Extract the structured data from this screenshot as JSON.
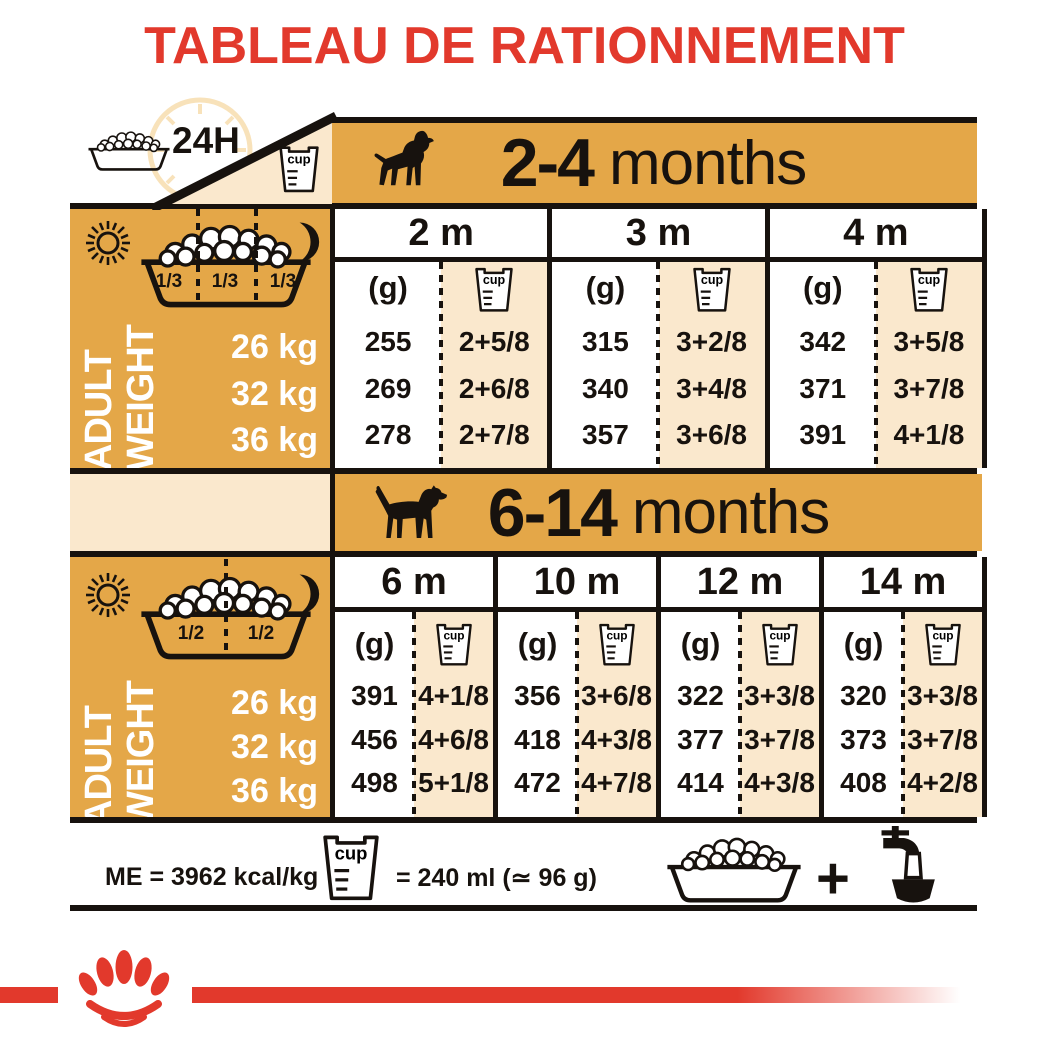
{
  "title": "TABLEAU DE RATIONNEMENT",
  "legend": {
    "hours": "24H",
    "cup": "cup"
  },
  "colors": {
    "orange": "#E4A748",
    "beige": "#FAE8CD",
    "red": "#E2392C",
    "ink": "#17120E"
  },
  "sections": [
    {
      "age_bold": "2-4",
      "age_rest": "months",
      "dog_icon": "puppy-silhouette",
      "bowl_fractions": [
        "1/3",
        "1/3",
        "1/3"
      ],
      "axis": {
        "line1": "ADULT",
        "line2": "WEIGHT"
      },
      "weights": [
        "26 kg",
        "32 kg",
        "36 kg"
      ],
      "g_label": "(g)",
      "columns": [
        {
          "month": "2 m",
          "grams": [
            "255",
            "269",
            "278"
          ],
          "cups": [
            "2+5/8",
            "2+6/8",
            "2+7/8"
          ]
        },
        {
          "month": "3 m",
          "grams": [
            "315",
            "340",
            "357"
          ],
          "cups": [
            "3+2/8",
            "3+4/8",
            "3+6/8"
          ]
        },
        {
          "month": "4 m",
          "grams": [
            "342",
            "371",
            "391"
          ],
          "cups": [
            "3+5/8",
            "3+7/8",
            "4+1/8"
          ]
        }
      ]
    },
    {
      "age_bold": "6-14",
      "age_rest": "months",
      "dog_icon": "adult-dog-silhouette",
      "bowl_fractions": [
        "1/2",
        "1/2"
      ],
      "axis": {
        "line1": "ADULT",
        "line2": "WEIGHT"
      },
      "weights": [
        "26 kg",
        "32 kg",
        "36 kg"
      ],
      "g_label": "(g)",
      "columns": [
        {
          "month": "6 m",
          "grams": [
            "391",
            "456",
            "498"
          ],
          "cups": [
            "4+1/8",
            "4+6/8",
            "5+1/8"
          ]
        },
        {
          "month": "10 m",
          "grams": [
            "356",
            "418",
            "472"
          ],
          "cups": [
            "3+6/8",
            "4+3/8",
            "4+7/8"
          ]
        },
        {
          "month": "12 m",
          "grams": [
            "322",
            "377",
            "414"
          ],
          "cups": [
            "3+3/8",
            "3+7/8",
            "4+3/8"
          ]
        },
        {
          "month": "14 m",
          "grams": [
            "320",
            "373",
            "408"
          ],
          "cups": [
            "3+3/8",
            "3+7/8",
            "4+2/8"
          ]
        }
      ]
    }
  ],
  "footer": {
    "me": "ME = 3962 kcal/kg",
    "equals": "= 240 ml (≃ 96 g)"
  },
  "chart_data": {
    "type": "table",
    "title": "TABLEAU DE RATIONNEMENT",
    "row_header": "ADULT WEIGHT",
    "rows": [
      "26 kg",
      "32 kg",
      "36 kg"
    ],
    "groups": [
      {
        "age": "2-4 months",
        "columns": [
          "2 m",
          "3 m",
          "4 m"
        ],
        "grams": [
          [
            255,
            315,
            342
          ],
          [
            269,
            340,
            371
          ],
          [
            278,
            357,
            391
          ]
        ],
        "cups": [
          [
            "2+5/8",
            "3+2/8",
            "3+5/8"
          ],
          [
            "2+6/8",
            "3+4/8",
            "3+7/8"
          ],
          [
            "2+7/8",
            "3+6/8",
            "4+1/8"
          ]
        ],
        "meals_per_day": "1/3 + 1/3 + 1/3"
      },
      {
        "age": "6-14 months",
        "columns": [
          "6 m",
          "10 m",
          "12 m",
          "14 m"
        ],
        "grams": [
          [
            391,
            356,
            322,
            320
          ],
          [
            456,
            418,
            377,
            373
          ],
          [
            498,
            472,
            414,
            408
          ]
        ],
        "cups": [
          [
            "4+1/8",
            "3+6/8",
            "3+3/8",
            "3+3/8"
          ],
          [
            "4+6/8",
            "4+3/8",
            "3+7/8",
            "3+7/8"
          ],
          [
            "5+1/8",
            "4+7/8",
            "4+3/8",
            "4+2/8"
          ]
        ],
        "meals_per_day": "1/2 + 1/2"
      }
    ],
    "notes": "ME = 3962 kcal/kg; 1 cup = 240 ml (≃ 96 g)"
  }
}
